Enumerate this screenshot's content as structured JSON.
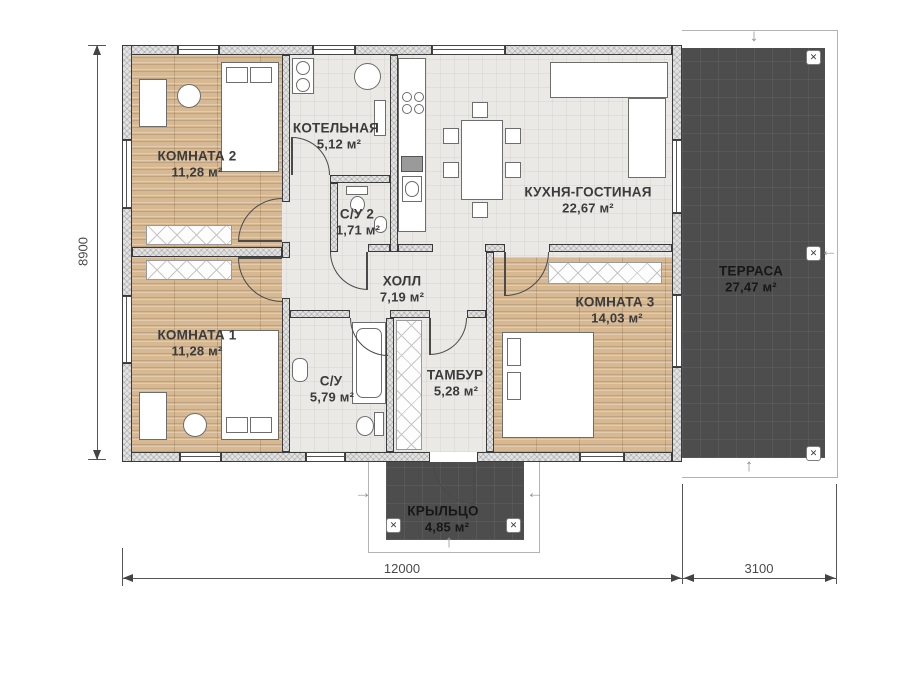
{
  "plan_title": "",
  "rooms": {
    "room2": {
      "name": "КОМНАТА 2",
      "area": "11,28 м²"
    },
    "boiler": {
      "name": "КОТЕЛЬНАЯ",
      "area": "5,12 м²"
    },
    "bath2": {
      "name": "С/У 2",
      "area": "1,71 м²"
    },
    "kitchen": {
      "name": "КУХНЯ-ГОСТИНАЯ",
      "area": "22,67 м²"
    },
    "hall": {
      "name": "ХОЛЛ",
      "area": "7,19 м²"
    },
    "room1": {
      "name": "КОМНАТА 1",
      "area": "11,28 м²"
    },
    "bath1": {
      "name": "С/У",
      "area": "5,79 м²"
    },
    "tambour": {
      "name": "ТАМБУР",
      "area": "5,28 м²"
    },
    "room3": {
      "name": "КОМНАТА 3",
      "area": "14,03 м²"
    },
    "terrace": {
      "name": "ТЕРРАСА",
      "area": "27,47 м²"
    },
    "porch": {
      "name": "КРЫЛЬЦО",
      "area": "4,85 м²"
    }
  },
  "dimensions": {
    "height": "8900",
    "width_main": "12000",
    "width_terrace": "3100"
  },
  "icons": {
    "column_marker": "✕",
    "arrow_up": "↑",
    "arrow_down": "↓",
    "arrow_left": "←",
    "arrow_right": "→"
  },
  "colors": {
    "wood_floor": "#d6b893",
    "tile_floor": "#eae9e6",
    "wall_fill": "#e2e2e2",
    "wall_line": "#3a3a3a",
    "deck_dark": "#4d4d4d",
    "label_text": "#3b3b3b"
  }
}
